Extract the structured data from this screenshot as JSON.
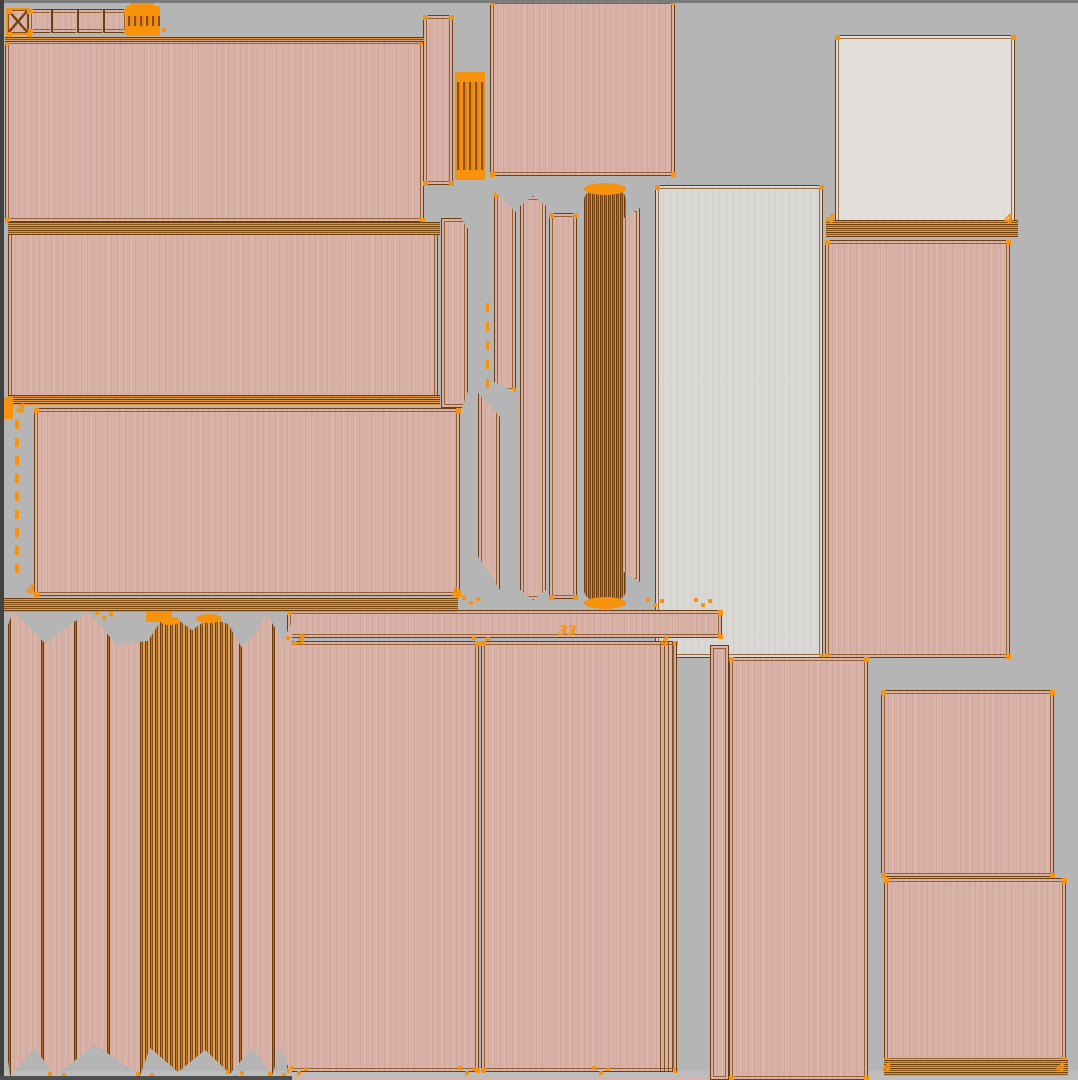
{
  "app": {
    "view": "uv-texture-editor-viewport",
    "description": "UV unwrap island layout over wood texture atlas, orange wireframe selection"
  },
  "palette": {
    "background": "#b5b5b5",
    "wood_pink": "#d8b2a6",
    "wood_light": "#d9d8d5",
    "wood_white": "#e2dfda",
    "edge_dark": "#6e3d0d",
    "edge_mid": "#8a5413",
    "selection_orange": "#f6920b",
    "frame_dark": "#414141"
  },
  "islands": [
    {
      "name": "tiny-square",
      "x": 6,
      "y": 8,
      "w": 24,
      "h": 27,
      "fill": "pink",
      "border": "orange",
      "xcross": true,
      "dots": true
    },
    {
      "name": "top-cell-band",
      "x": 28,
      "y": 9,
      "w": 100,
      "h": 24,
      "fill": "pink",
      "border": "double",
      "dots": true
    },
    {
      "name": "top-cluster",
      "x": 126,
      "y": 6,
      "w": 34,
      "h": 30,
      "fill": "cluster"
    },
    {
      "name": "big-rect-1",
      "x": 5,
      "y": 40,
      "w": 419,
      "h": 182,
      "fill": "pink",
      "border": "double",
      "dots": true
    },
    {
      "name": "big-rect-2",
      "x": 8,
      "y": 226,
      "w": 430,
      "h": 178,
      "fill": "pink",
      "border": "double",
      "dots": true
    },
    {
      "name": "bevel-strip",
      "x": 441,
      "y": 218,
      "w": 27,
      "h": 190,
      "fill": "pink",
      "border": "double",
      "clip": "0 0,75% 0,100% 6%,100% 91%,78% 100%,0 100%"
    },
    {
      "name": "big-rect-3",
      "x": 34,
      "y": 408,
      "w": 426,
      "h": 188,
      "fill": "pink",
      "border": "double",
      "dots": true
    },
    {
      "name": "strip-a",
      "x": 423,
      "y": 15,
      "w": 30,
      "h": 170,
      "fill": "pink",
      "border": "double",
      "dots": true
    },
    {
      "name": "cluster-1",
      "x": 455,
      "y": 72,
      "w": 30,
      "h": 108,
      "fill": "cluster"
    },
    {
      "name": "rect-top-mid",
      "x": 490,
      "y": 0,
      "w": 185,
      "h": 176,
      "fill": "pink",
      "border": "double",
      "dots": true
    },
    {
      "name": "mid-strip-1",
      "x": 494,
      "y": 192,
      "w": 22,
      "h": 200,
      "fill": "pink",
      "border": "double",
      "clip": "0 0,100% 10%,100% 100%,0 95%",
      "dots": true
    },
    {
      "name": "mid-strip-0",
      "x": 478,
      "y": 393,
      "w": 22,
      "h": 197,
      "fill": "pink",
      "border": "double",
      "clip": "0 0,100% 12%,100% 100%,0 83%"
    },
    {
      "name": "mid-strip-2",
      "x": 520,
      "y": 196,
      "w": 26,
      "h": 404,
      "fill": "pink",
      "border": "double",
      "clip": "50% 0,100% 2.5%,100% 97.5%,50% 100%,0 97.5%,0 2.5%",
      "dots": true
    },
    {
      "name": "mid-strip-3",
      "x": 549,
      "y": 213,
      "w": 28,
      "h": 386,
      "fill": "pink",
      "border": "double",
      "dots": true
    },
    {
      "name": "mid-dense",
      "x": 584,
      "y": 188,
      "w": 42,
      "h": 414,
      "fill": "dense",
      "r": "16px/12px"
    },
    {
      "name": "mid-strip-4",
      "x": 622,
      "y": 208,
      "w": 18,
      "h": 374,
      "fill": "pink",
      "border": "double",
      "clip": "100% 0,100% 100%,0 97%,0 3%"
    },
    {
      "name": "light-rect",
      "x": 655,
      "y": 185,
      "w": 168,
      "h": 473,
      "fill": "light",
      "border": "double",
      "dots": true
    },
    {
      "name": "right-top-light",
      "x": 835,
      "y": 35,
      "w": 180,
      "h": 190,
      "fill": "white",
      "border": "double",
      "dots": true
    },
    {
      "name": "right-big",
      "x": 825,
      "y": 240,
      "w": 185,
      "h": 418,
      "fill": "pink",
      "border": "double",
      "dots": true
    },
    {
      "name": "right-mid",
      "x": 881,
      "y": 690,
      "w": 173,
      "h": 187,
      "fill": "pink",
      "border": "double",
      "dots": true
    },
    {
      "name": "right-bottom",
      "x": 884,
      "y": 878,
      "w": 182,
      "h": 184,
      "fill": "pink",
      "border": "double",
      "dots": true
    },
    {
      "name": "bottom-mid-1",
      "x": 287,
      "y": 641,
      "w": 192,
      "h": 431,
      "fill": "pink",
      "border": "double",
      "dots": true
    },
    {
      "name": "bottom-mid-2",
      "x": 481,
      "y": 641,
      "w": 196,
      "h": 431,
      "fill": "pink",
      "border": "double",
      "dots": true
    },
    {
      "name": "bottom-mid-2-seam",
      "x": 660,
      "y": 642,
      "w": 18,
      "h": 429,
      "fill": "stripesv"
    },
    {
      "name": "bottom-right-strip",
      "x": 710,
      "y": 645,
      "w": 19,
      "h": 435,
      "fill": "pink",
      "border": "double"
    },
    {
      "name": "bottom-right-rect",
      "x": 729,
      "y": 657,
      "w": 139,
      "h": 423,
      "fill": "pink",
      "border": "double",
      "dots": true
    },
    {
      "name": "horizontal-band",
      "x": 287,
      "y": 610,
      "w": 435,
      "h": 28,
      "fill": "pink",
      "border": "double",
      "dots": true
    },
    {
      "name": "accordion-region",
      "x": 8,
      "y": 610,
      "w": 284,
      "h": 468,
      "fill": "zigzag",
      "clip": "0 3.2%,1.8% 0.2%,13% 7.1%,28.2% 0.4%,38.4% 7.5%,49.3% 6.6%,53.5% 2.6%,59.9% 2.1%,64.8% 4.3%,71.1% 1.7%,77.5% 3%,82.4% 8.1%,88% 4.3%,90.8% 0.6%,96.8% 6.6%,100% 2.6%,100% 100%,96.1% 93.4%,93% 99.4%,85.9% 93.6%,78.2% 99.1%,69.4% 94%,59.9% 98.7%,50% 93.6%,46.5% 99.4%,30.6% 92.9%,16.5% 99.6%,9.5% 93.6%,0.7% 99.6%,0 96.2%"
    }
  ],
  "bands": [
    {
      "name": "left-hstack-band",
      "x": 0,
      "y": 598,
      "w": 458,
      "h": 14
    },
    {
      "name": "rect2-top-band",
      "x": 8,
      "y": 222,
      "w": 432,
      "h": 13
    },
    {
      "name": "rect2-bottom-band",
      "x": 8,
      "y": 395,
      "w": 432,
      "h": 10
    },
    {
      "name": "rect1-top-band",
      "x": 5,
      "y": 37,
      "w": 419,
      "h": 5
    },
    {
      "name": "right-top-band",
      "x": 826,
      "y": 220,
      "w": 192,
      "h": 17
    },
    {
      "name": "right-bottom-band",
      "x": 884,
      "y": 1060,
      "w": 184,
      "h": 16
    }
  ],
  "vlines": [
    {
      "x": 50,
      "y": 10,
      "h": 23
    },
    {
      "x": 76,
      "y": 10,
      "h": 23
    },
    {
      "x": 102,
      "y": 10,
      "h": 23
    }
  ],
  "arcs": [
    {
      "x": 584,
      "y": 183,
      "w": 42,
      "h": 12
    },
    {
      "x": 584,
      "y": 597,
      "w": 42,
      "h": 12
    },
    {
      "x": 160,
      "y": 617,
      "w": 20,
      "h": 8
    },
    {
      "x": 196,
      "y": 614,
      "w": 26,
      "h": 9
    }
  ],
  "blobs": [
    {
      "x": 130,
      "y": 1,
      "w": 24,
      "h": 8
    },
    {
      "x": 0,
      "y": 397,
      "w": 13,
      "h": 22
    },
    {
      "x": 146,
      "y": 612,
      "w": 26,
      "h": 10
    }
  ],
  "glyph_markers": [
    {
      "label": "4",
      "x": 16,
      "y": 403
    },
    {
      "label": "4",
      "x": 26,
      "y": 584
    },
    {
      "label": "b",
      "x": 452,
      "y": 587
    },
    {
      "label": "33",
      "x": 558,
      "y": 625
    },
    {
      "label": "4",
      "x": 660,
      "y": 636
    },
    {
      "label": "3",
      "x": 296,
      "y": 634
    },
    {
      "label": "4",
      "x": 826,
      "y": 213
    },
    {
      "label": "4",
      "x": 1004,
      "y": 213
    },
    {
      "label": "4",
      "x": 882,
      "y": 1062
    },
    {
      "label": "4",
      "x": 1056,
      "y": 1062
    }
  ],
  "dot_clusters": [
    {
      "x": 148,
      "y": 27
    },
    {
      "x": 95,
      "y": 611
    },
    {
      "x": 462,
      "y": 596
    },
    {
      "x": 646,
      "y": 598
    },
    {
      "x": 694,
      "y": 598
    },
    {
      "x": 286,
      "y": 636
    },
    {
      "x": 472,
      "y": 636
    },
    {
      "x": 290,
      "y": 1066
    },
    {
      "x": 458,
      "y": 1066
    },
    {
      "x": 592,
      "y": 1066
    },
    {
      "x": 48,
      "y": 1072
    },
    {
      "x": 136,
      "y": 1072
    },
    {
      "x": 226,
      "y": 1070
    },
    {
      "x": 268,
      "y": 1072
    }
  ],
  "dash_columns": [
    {
      "x": 486,
      "y": 303,
      "step": 19,
      "count": 5,
      "w": 3,
      "h": 9
    },
    {
      "x": 15,
      "y": 420,
      "step": 18,
      "count": 9,
      "w": 4,
      "h": 9
    }
  ],
  "frame_bars": [
    {
      "name": "top-edge-line",
      "x": 0,
      "y": 0,
      "w": 1078,
      "h": 3,
      "color": "#7c7c7c",
      "z": 40
    },
    {
      "name": "left-edge-bar",
      "x": 0,
      "y": 0,
      "w": 4,
      "h": 1080,
      "color": "#414141",
      "z": 41
    },
    {
      "name": "bottom-gray-bar",
      "x": 0,
      "y": 1071,
      "w": 1078,
      "h": 9,
      "color": "#bdbdbd",
      "z": 5
    },
    {
      "name": "bottom-dark-line",
      "x": 0,
      "y": 1076,
      "w": 292,
      "h": 4,
      "color": "#4f4f4f",
      "z": 42
    },
    {
      "name": "bottom-pink-row",
      "x": 292,
      "y": 1077,
      "w": 418,
      "h": 3,
      "color": "#d8b2a6",
      "z": 42
    }
  ]
}
